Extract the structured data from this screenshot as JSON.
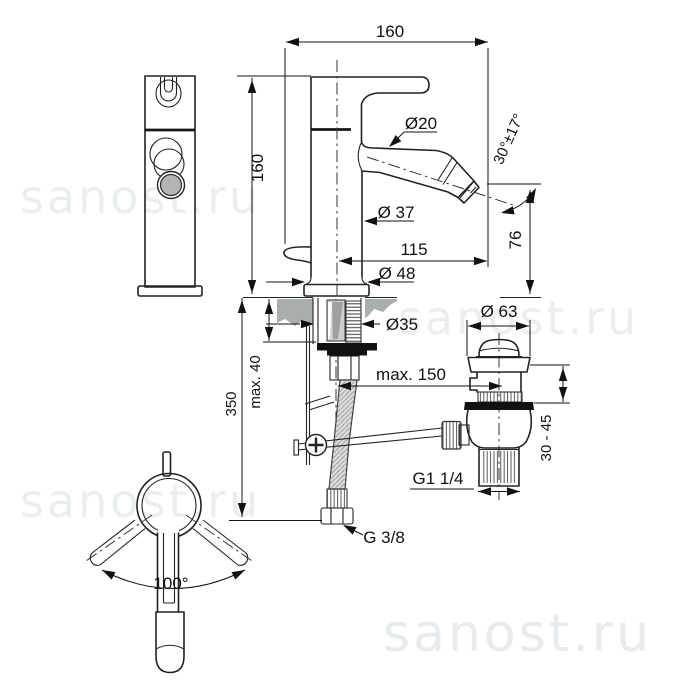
{
  "watermark": {
    "text": "sanost.ru"
  },
  "drawing_title": "bidet-mixer-with-popup-waste-dimensional-drawing",
  "colors": {
    "line": "#222222",
    "deck_gray": "#a9adac",
    "spout_face_gray": "#b4b4b4",
    "gasket_black": "#111111",
    "watermark_gray": "#eaeeef"
  },
  "dimensions": {
    "total_width": "160",
    "body_height": "160",
    "aerator_diameter": "Ø20",
    "spout_angle": "30°±17°",
    "body_diameter": "Ø 37",
    "spout_reach": "115",
    "spout_height": "76",
    "base_diameter": "Ø 48",
    "shank_diameter": "Ø35",
    "deck_thickness_max": "max. 40",
    "hose_length": "350",
    "rod_reach_max": "max. 150",
    "waste_flange_diameter": "Ø 63",
    "waste_height_range": "30 - 45",
    "waste_thread": "G1 1/4",
    "supply_thread": "G 3/8",
    "handle_swivel_angle": "100°"
  }
}
